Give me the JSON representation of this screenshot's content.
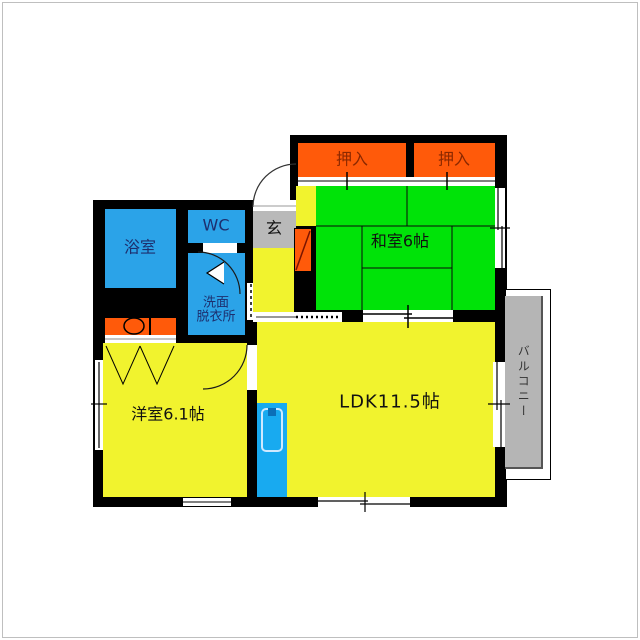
{
  "plan": {
    "type": "japanese-apartment-floor-plan",
    "rooms": {
      "oshiire_left": "押入",
      "oshiire_right": "押入",
      "washitsu": "和室6帖",
      "bath": "浴室",
      "wc": "WC",
      "senmen_line1": "洗面",
      "senmen_line2": "脱衣所",
      "genkan": "玄",
      "youshitsu": "洋室6.1帖",
      "ldk": "LDK11.5帖",
      "balcony": "バルコニー"
    },
    "colors": {
      "tatami_green": "#00e308",
      "room_yellow": "#f1f32e",
      "closet_orange": "#ff5a0a",
      "wet_area_blue": "#2ba3e8",
      "kitchen_blue": "#18aaf0",
      "entry_gray": "#b9b9b9",
      "balcony_gray": "#b5b5b5",
      "wall_black": "#000000",
      "oshiire_text": "#8b2800",
      "wet_text": "#1d2f6e"
    }
  }
}
